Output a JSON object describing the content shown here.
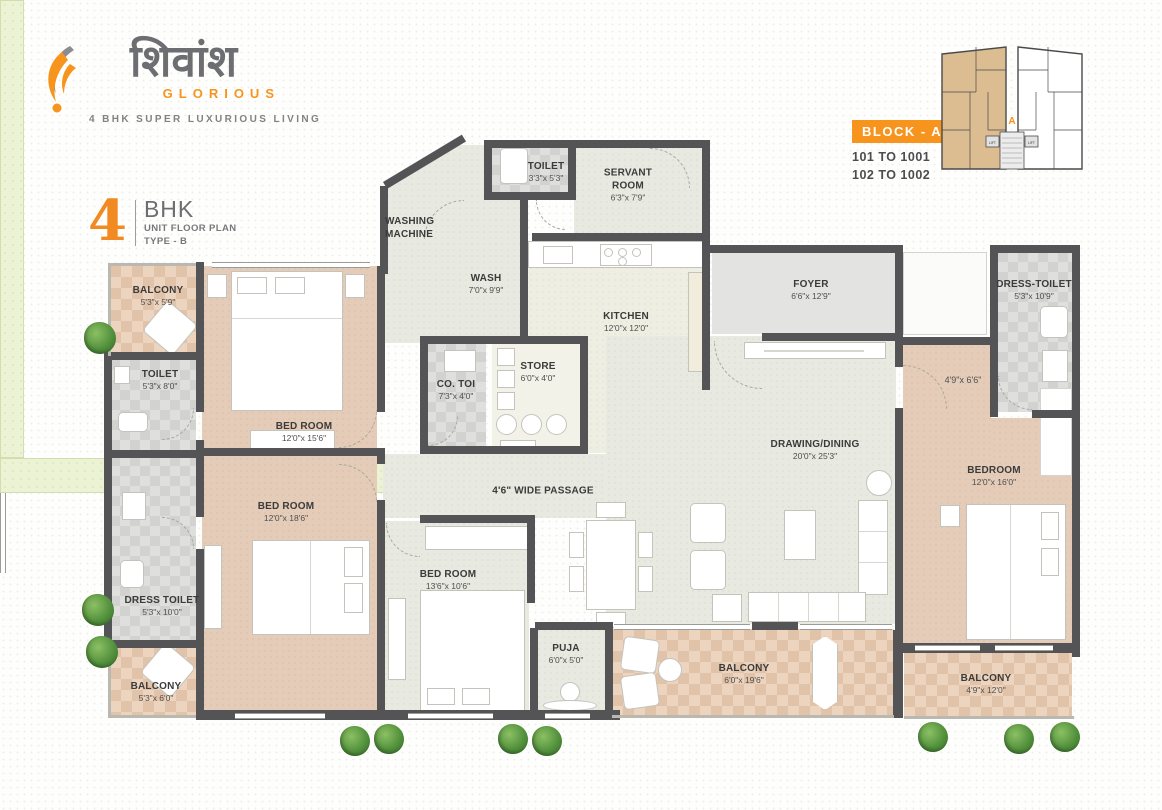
{
  "brand": {
    "logo_text": "शिवांश",
    "logo_sub": "GLORIOUS",
    "tagline": "4 BHK SUPER LUXURIOUS LIVING"
  },
  "unit_title": {
    "number": "4",
    "type": "BHK",
    "line1": "UNIT FLOOR PLAN",
    "line2": "TYPE - B"
  },
  "block_info": {
    "badge": "BLOCK - A",
    "range1": "101 TO 1001",
    "range2": "102 TO 1002",
    "unit_letter": "A",
    "lift": "LIFT"
  },
  "colors": {
    "accent_orange": "#F7941D",
    "wall_dark": "#545356",
    "bedroom_tan": "#E5CCB8",
    "balcony_tan": "#E9D0BA",
    "toilet_gray": "#DBDBDA",
    "room_light": "#E8E9E0",
    "foyer_gray": "#E3E3E2",
    "grass_green": "#ECF3D4"
  },
  "rooms": {
    "balcony_tl": {
      "name": "BALCONY",
      "dim": "5'3\"x 5'9\""
    },
    "bedroom1": {
      "name": "BED ROOM",
      "dim": "12'0\"x 15'6\""
    },
    "toilet_left": {
      "name": "TOILET",
      "dim": "5'3\"x 8'0\""
    },
    "bedroom2": {
      "name": "BED ROOM",
      "dim": "12'0\"x 18'6\""
    },
    "dress_toilet_left": {
      "name": "DRESS TOILET",
      "dim": "5'3\"x 10'0\""
    },
    "balcony_bl": {
      "name": "BALCONY",
      "dim": "5'3\"x 6'0\""
    },
    "washing": {
      "name": "WASHING MACHINE",
      "dim": ""
    },
    "wash": {
      "name": "WASH",
      "dim": "7'0\"x 9'9\""
    },
    "toilet_top": {
      "name": "TOILET",
      "dim": "3'3\"x 5'3\""
    },
    "servant": {
      "name": "SERVANT ROOM",
      "dim": "6'3\"x 7'9\""
    },
    "kitchen": {
      "name": "KITCHEN",
      "dim": "12'0\"x 12'0\""
    },
    "co_toi": {
      "name": "CO. TOI",
      "dim": "7'3\"x 4'0\""
    },
    "store": {
      "name": "STORE",
      "dim": "6'0\"x 4'0\""
    },
    "passage": {
      "name": "4'6\" WIDE PASSAGE",
      "dim": ""
    },
    "bedroom3": {
      "name": "BED ROOM",
      "dim": "13'6\"x 10'6\""
    },
    "puja": {
      "name": "PUJA",
      "dim": "6'0\"x 5'0\""
    },
    "foyer": {
      "name": "FOYER",
      "dim": "6'6\"x 12'9\""
    },
    "drawing": {
      "name": "DRAWING/DINING",
      "dim": "20'0\"x 25'3\""
    },
    "passage4": {
      "name": "",
      "dim": "4'9\"x 6'6\""
    },
    "bedroom4": {
      "name": "BEDROOM",
      "dim": "12'0\"x 16'0\""
    },
    "dress_toilet_right": {
      "name": "DRESS-TOILET",
      "dim": "5'3\"x 10'9\""
    },
    "balcony_mid": {
      "name": "BALCONY",
      "dim": "6'0\"x 19'6\""
    },
    "balcony_br": {
      "name": "BALCONY",
      "dim": "4'9\"x 12'0\""
    }
  }
}
